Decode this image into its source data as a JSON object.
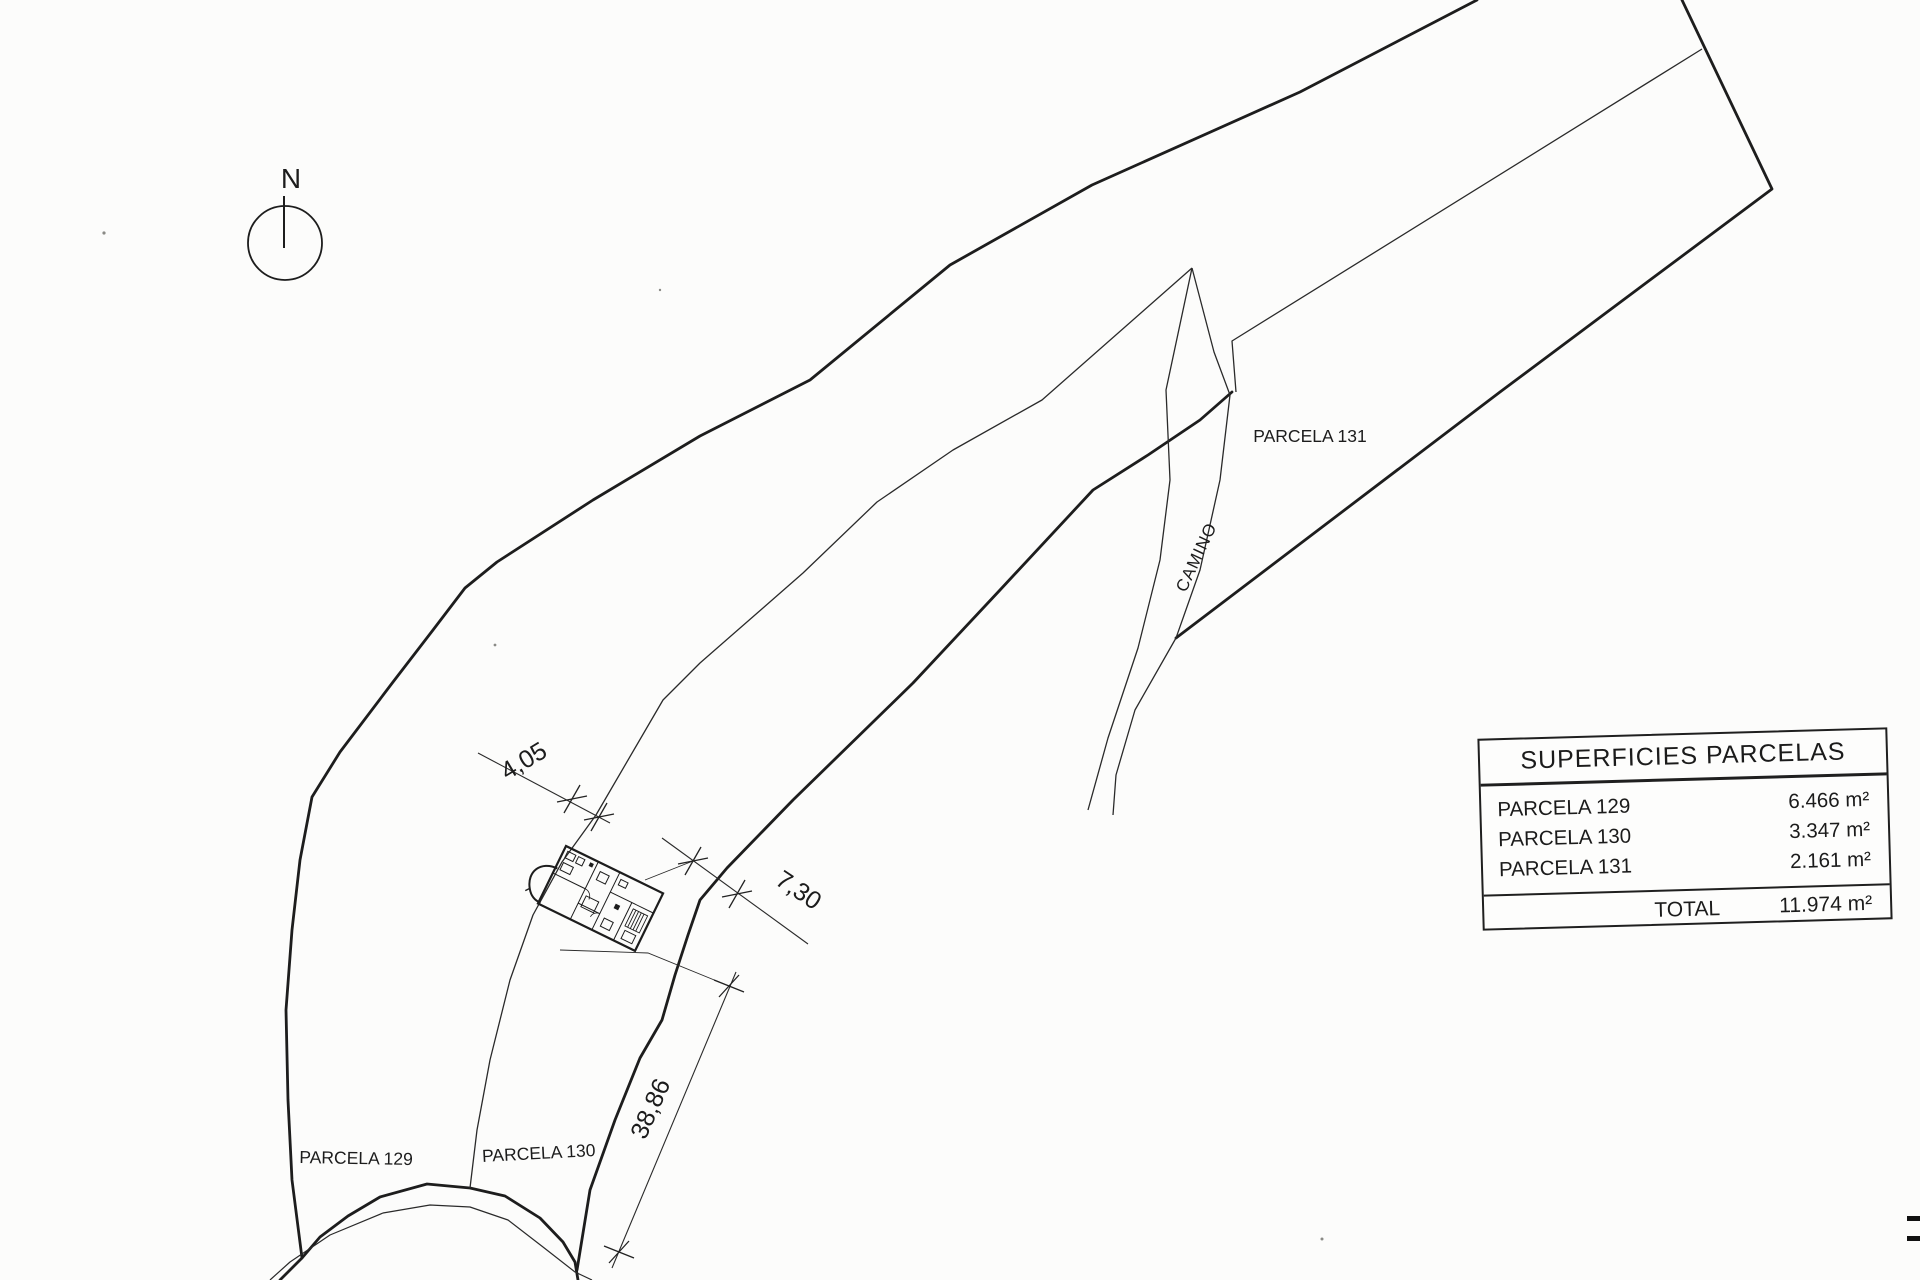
{
  "scan": {
    "north_label": "N",
    "parcel_labels": {
      "p129": "PARCELA 129",
      "p130": "PARCELA 130",
      "p131": "PARCELA 131"
    },
    "road_label": "CAMINO",
    "dimension_labels": {
      "d1": "4,05",
      "d2": "7,30",
      "d3": "38,86"
    }
  },
  "table": {
    "title": "SUPERFICIES PARCELAS",
    "rows": [
      {
        "label": "PARCELA 129",
        "value": "6.466 m²"
      },
      {
        "label": "PARCELA 130",
        "value": "3.347 m²"
      },
      {
        "label": "PARCELA 131",
        "value": "2.161 m²"
      }
    ],
    "total_label": "TOTAL",
    "total_value": "11.974 m²"
  }
}
